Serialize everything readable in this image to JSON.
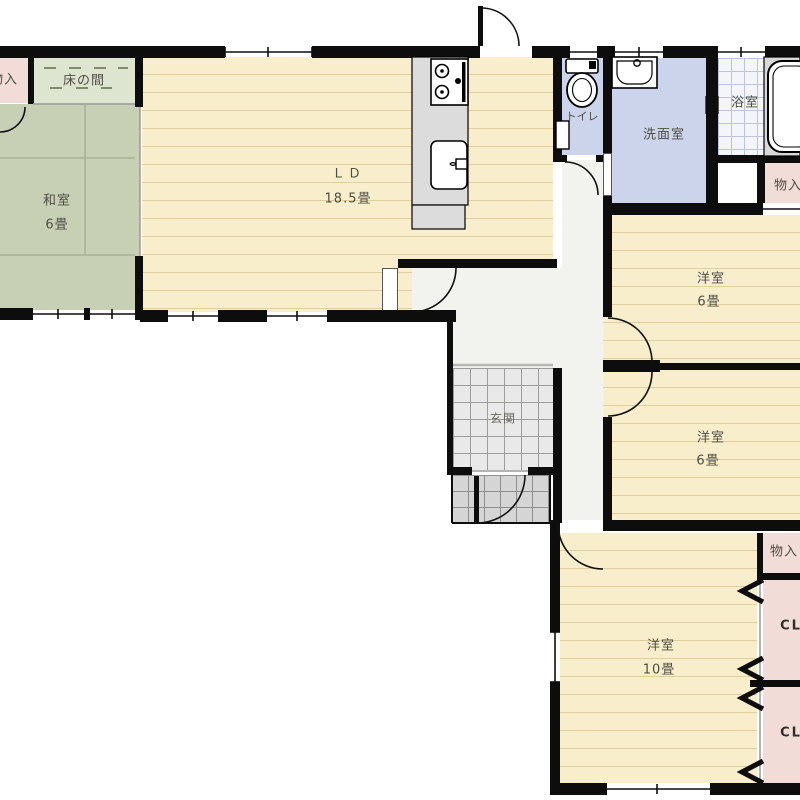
{
  "floorplan": {
    "title": "房屋平面图 (間取り図)",
    "rooms": {
      "monoire_tl": {
        "label": "物入"
      },
      "tokonoma": {
        "label": "床の間"
      },
      "washitsu": {
        "label": "和室",
        "size": "6畳"
      },
      "ld": {
        "label": "ＬＤ",
        "size": "18.5畳"
      },
      "toilet": {
        "label": "トイレ"
      },
      "senmen": {
        "label": "洗面室"
      },
      "bath": {
        "label": "浴室"
      },
      "monoire_bath": {
        "label": "物入"
      },
      "yoshitsu1": {
        "label": "洋室",
        "size": "6畳"
      },
      "yoshitsu2": {
        "label": "洋室",
        "size": "6畳"
      },
      "genkan": {
        "label": "玄関"
      },
      "monoire_br": {
        "label": "物入"
      },
      "cl1": {
        "label": "CL"
      },
      "yoshitsu3": {
        "label": "洋室",
        "size": "10畳"
      },
      "cl2": {
        "label": "CL"
      }
    },
    "colors": {
      "floor_cream": "#f8eecb",
      "tatami_green": "#c7cfb5",
      "tokonoma_green": "#dde4cf",
      "closet_pink": "#f1dcd7",
      "wet_area_blue": "#ccd4ec",
      "wall_black": "#0d0d0d",
      "label_text": "#4e4d44"
    }
  }
}
